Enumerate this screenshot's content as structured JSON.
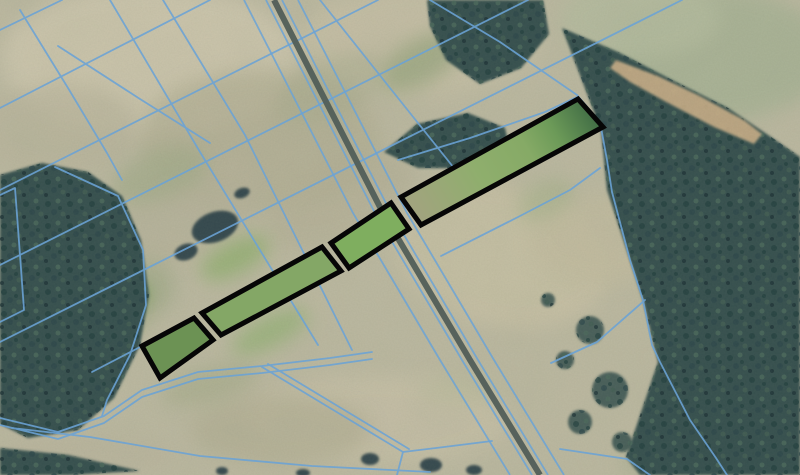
{
  "canvas": {
    "width": 800,
    "height": 475
  },
  "colors": {
    "field_base": "#bcb8a0",
    "cadastral_line_blue": "#6ba3d6",
    "parcel_highlight_stroke": "#060606",
    "forest_base": "#36504d",
    "forest_canopy": [
      "#24403f",
      "#4a675b",
      "#2c4749",
      "#1e3336",
      "#415c52"
    ],
    "road_band": "#515e59",
    "sand": "#c9ae87"
  },
  "field_patches": [
    [
      150,
      60,
      150,
      75,
      0,
      "#cdc6ad",
      0.9
    ],
    [
      420,
      40,
      120,
      55,
      0,
      "#c6bfa5",
      0.8
    ],
    [
      720,
      55,
      110,
      65,
      0,
      "#a9b295",
      0.95
    ],
    [
      640,
      18,
      80,
      40,
      0,
      "#b4bb9e",
      0.8
    ],
    [
      60,
      130,
      80,
      45,
      0,
      "#b9b49b",
      0.7
    ],
    [
      260,
      140,
      120,
      70,
      0,
      "#b1ad92",
      0.7
    ],
    [
      180,
      210,
      90,
      50,
      -20,
      "#b6b199",
      0.7
    ],
    [
      340,
      200,
      80,
      40,
      -25,
      "#b3ae94",
      0.6
    ],
    [
      500,
      255,
      110,
      70,
      15,
      "#c7c0a4",
      0.9
    ],
    [
      600,
      240,
      70,
      45,
      0,
      "#c2bb9f",
      0.8
    ],
    [
      380,
      420,
      130,
      45,
      0,
      "#c6bfa6",
      0.85
    ],
    [
      280,
      430,
      90,
      35,
      0,
      "#b2ae93",
      0.7
    ],
    [
      120,
      300,
      60,
      35,
      -25,
      "#9fa886",
      0.6
    ],
    [
      90,
      455,
      90,
      20,
      0,
      "#b9b49c",
      0.8
    ],
    [
      680,
      462,
      60,
      18,
      0,
      "#a7ad8f",
      0.6
    ],
    [
      100,
      318,
      40,
      20,
      -27,
      "#7fa55e",
      0.85
    ],
    [
      130,
      298,
      22,
      12,
      -27,
      "#6f9852",
      0.8
    ],
    [
      235,
      258,
      38,
      16,
      -27,
      "#8aad68",
      0.7
    ],
    [
      270,
      332,
      42,
      15,
      -27,
      "#93b173",
      0.75
    ],
    [
      160,
      175,
      50,
      25,
      -20,
      "#9aa882",
      0.5
    ],
    [
      420,
      62,
      45,
      22,
      -30,
      "#8d9f74",
      0.6
    ],
    [
      330,
      90,
      60,
      30,
      -25,
      "#a8ab8d",
      0.5
    ],
    [
      545,
      200,
      30,
      18,
      -25,
      "#9fae84",
      0.5
    ],
    [
      210,
      385,
      50,
      18,
      -15,
      "#a4aa88",
      0.6
    ],
    [
      460,
      390,
      40,
      16,
      0,
      "#b7b99a",
      0.5
    ]
  ],
  "forests": [
    {
      "name": "left-forest",
      "points": [
        [
          0,
          175
        ],
        [
          42,
          163
        ],
        [
          88,
          172
        ],
        [
          122,
          196
        ],
        [
          141,
          240
        ],
        [
          149,
          295
        ],
        [
          140,
          345
        ],
        [
          114,
          398
        ],
        [
          78,
          430
        ],
        [
          28,
          438
        ],
        [
          0,
          424
        ]
      ]
    },
    {
      "name": "east-forest",
      "points": [
        [
          562,
          28
        ],
        [
          618,
          52
        ],
        [
          678,
          83
        ],
        [
          728,
          108
        ],
        [
          774,
          139
        ],
        [
          800,
          157
        ],
        [
          800,
          475
        ],
        [
          640,
          475
        ],
        [
          626,
          457
        ],
        [
          658,
          362
        ],
        [
          643,
          300
        ],
        [
          607,
          190
        ],
        [
          601,
          130
        ]
      ]
    },
    {
      "name": "top-middle-trees",
      "points": [
        [
          427,
          0
        ],
        [
          543,
          0
        ],
        [
          549,
          34
        ],
        [
          521,
          68
        ],
        [
          480,
          84
        ],
        [
          446,
          60
        ],
        [
          430,
          26
        ]
      ]
    },
    {
      "name": "tree-shadow-clump",
      "points": [
        [
          384,
          152
        ],
        [
          417,
          124
        ],
        [
          468,
          113
        ],
        [
          505,
          128
        ],
        [
          511,
          154
        ],
        [
          470,
          168
        ],
        [
          418,
          168
        ]
      ]
    },
    {
      "name": "bottom-left-trees",
      "points": [
        [
          0,
          448
        ],
        [
          68,
          455
        ],
        [
          140,
          471
        ],
        [
          70,
          475
        ],
        [
          0,
          475
        ]
      ]
    }
  ],
  "forest_scatter": [
    [
      590,
      330,
      14
    ],
    [
      610,
      390,
      18
    ],
    [
      580,
      422,
      12
    ],
    [
      622,
      442,
      10
    ],
    [
      565,
      360,
      9
    ],
    [
      548,
      300,
      7
    ]
  ],
  "tree_clumps": [
    [
      215,
      227,
      24,
      15,
      -20
    ],
    [
      186,
      252,
      12,
      8,
      -20
    ],
    [
      242,
      193,
      8,
      5,
      -20
    ],
    [
      370,
      459,
      9,
      6,
      0
    ],
    [
      431,
      465,
      11,
      7,
      0
    ],
    [
      474,
      470,
      8,
      5,
      0
    ],
    [
      303,
      473,
      7,
      4,
      0
    ],
    [
      222,
      471,
      6,
      4,
      0
    ]
  ],
  "sand_strip": [
    [
      616,
      60
    ],
    [
      658,
      76
    ],
    [
      700,
      96
    ],
    [
      744,
      120
    ],
    [
      762,
      134
    ],
    [
      754,
      144
    ],
    [
      714,
      127
    ],
    [
      668,
      103
    ],
    [
      630,
      82
    ],
    [
      610,
      68
    ]
  ],
  "cadastral_lines": [
    {
      "pts": [
        [
          0,
          30
        ],
        [
          62,
          0
        ]
      ]
    },
    {
      "pts": [
        [
          0,
          108
        ],
        [
          210,
          0
        ]
      ]
    },
    {
      "pts": [
        [
          0,
          190
        ],
        [
          378,
          0
        ]
      ]
    },
    {
      "pts": [
        [
          0,
          265
        ],
        [
          528,
          0
        ]
      ]
    },
    {
      "pts": [
        [
          0,
          342
        ],
        [
          682,
          0
        ]
      ]
    },
    {
      "pts": [
        [
          58,
          46
        ],
        [
          140,
          99
        ],
        [
          210,
          143
        ]
      ]
    },
    {
      "pts": [
        [
          20,
          10
        ],
        [
          68,
          88
        ],
        [
          107,
          153
        ],
        [
          122,
          180
        ]
      ]
    },
    {
      "pts": [
        [
          110,
          0
        ],
        [
          200,
          152
        ],
        [
          318,
          345
        ]
      ]
    },
    {
      "pts": [
        [
          163,
          0
        ],
        [
          245,
          135
        ],
        [
          352,
          350
        ]
      ]
    },
    {
      "pts": [
        [
          320,
          0
        ],
        [
          390,
          88
        ],
        [
          454,
          168
        ]
      ]
    },
    {
      "pts": [
        [
          430,
          0
        ],
        [
          500,
          42
        ],
        [
          545,
          73
        ],
        [
          577,
          95
        ],
        [
          600,
          122
        ],
        [
          607,
          160
        ],
        [
          612,
          192
        ],
        [
          630,
          260
        ],
        [
          643,
          300
        ],
        [
          652,
          345
        ],
        [
          660,
          362
        ],
        [
          690,
          420
        ],
        [
          716,
          458
        ],
        [
          727,
          475
        ]
      ]
    },
    {
      "pts": [
        [
          398,
          160
        ],
        [
          470,
          138
        ],
        [
          545,
          112
        ],
        [
          577,
          97
        ]
      ]
    },
    {
      "pts": [
        [
          55,
          167
        ],
        [
          118,
          196
        ],
        [
          143,
          250
        ],
        [
          146,
          305
        ],
        [
          130,
          355
        ],
        [
          107,
          400
        ],
        [
          102,
          416
        ]
      ]
    },
    {
      "pts": [
        [
          0,
          195
        ],
        [
          15,
          188
        ],
        [
          20,
          255
        ],
        [
          24,
          310
        ],
        [
          0,
          322
        ]
      ]
    },
    {
      "pts": [
        [
          92,
          372
        ],
        [
          142,
          346
        ]
      ]
    },
    {
      "pts": [
        [
          441,
          256
        ],
        [
          520,
          216
        ],
        [
          570,
          190
        ],
        [
          600,
          168
        ]
      ]
    },
    {
      "pts": [
        [
          0,
          418
        ],
        [
          58,
          432
        ],
        [
          104,
          416
        ],
        [
          142,
          390
        ],
        [
          198,
          372
        ],
        [
          262,
          366
        ],
        [
          330,
          358
        ],
        [
          372,
          352
        ]
      ],
      "double": [
        0,
        7
      ]
    },
    {
      "pts": [
        [
          262,
          367
        ],
        [
          330,
          408
        ],
        [
          403,
          452
        ]
      ],
      "double": [
        6,
        -3
      ]
    },
    {
      "pts": [
        [
          403,
          452
        ],
        [
          436,
          448
        ],
        [
          492,
          441
        ]
      ]
    },
    {
      "pts": [
        [
          403,
          452
        ],
        [
          397,
          475
        ]
      ]
    },
    {
      "pts": [
        [
          12,
          428
        ],
        [
          90,
          437
        ],
        [
          200,
          456
        ],
        [
          312,
          466
        ],
        [
          430,
          472
        ]
      ]
    },
    {
      "pts": [
        [
          560,
          449
        ],
        [
          627,
          459
        ],
        [
          650,
          475
        ]
      ]
    },
    {
      "pts": [
        [
          645,
          300
        ],
        [
          597,
          342
        ],
        [
          551,
          363
        ]
      ]
    }
  ],
  "road": {
    "pts": [
      [
        274,
        0
      ],
      [
        320,
        90
      ],
      [
        383,
        213
      ],
      [
        470,
        360
      ],
      [
        540,
        475
      ]
    ],
    "band_width": 6,
    "line_offsets": [
      -30,
      -8,
      8,
      24
    ]
  },
  "highlighted_parcels": [
    {
      "id": "parcel-1",
      "fill": "#6c9254",
      "points": [
        [
          142,
          346
        ],
        [
          194,
          318
        ],
        [
          213,
          340
        ],
        [
          160,
          378
        ]
      ]
    },
    {
      "id": "parcel-2",
      "fill": "#84a766",
      "points": [
        [
          202,
          313
        ],
        [
          322,
          247
        ],
        [
          341,
          271
        ],
        [
          221,
          335
        ]
      ]
    },
    {
      "id": "parcel-3",
      "fill": "#7fae5f",
      "points": [
        [
          331,
          243
        ],
        [
          391,
          203
        ],
        [
          409,
          229
        ],
        [
          349,
          268
        ]
      ]
    },
    {
      "id": "parcel-4",
      "fill": "url(#gradD)",
      "points": [
        [
          401,
          197
        ],
        [
          578,
          99
        ],
        [
          603,
          127
        ],
        [
          421,
          225
        ]
      ]
    }
  ],
  "parcel_gradient": {
    "x1": 420,
    "y1": 215,
    "x2": 595,
    "y2": 112,
    "stops": [
      [
        "0",
        "#a1a47e"
      ],
      [
        "0.35",
        "#8fae6d"
      ],
      [
        "0.62",
        "#86aa66"
      ],
      [
        "0.78",
        "#6c9a58"
      ],
      [
        "1",
        "#3f6b44"
      ]
    ]
  }
}
